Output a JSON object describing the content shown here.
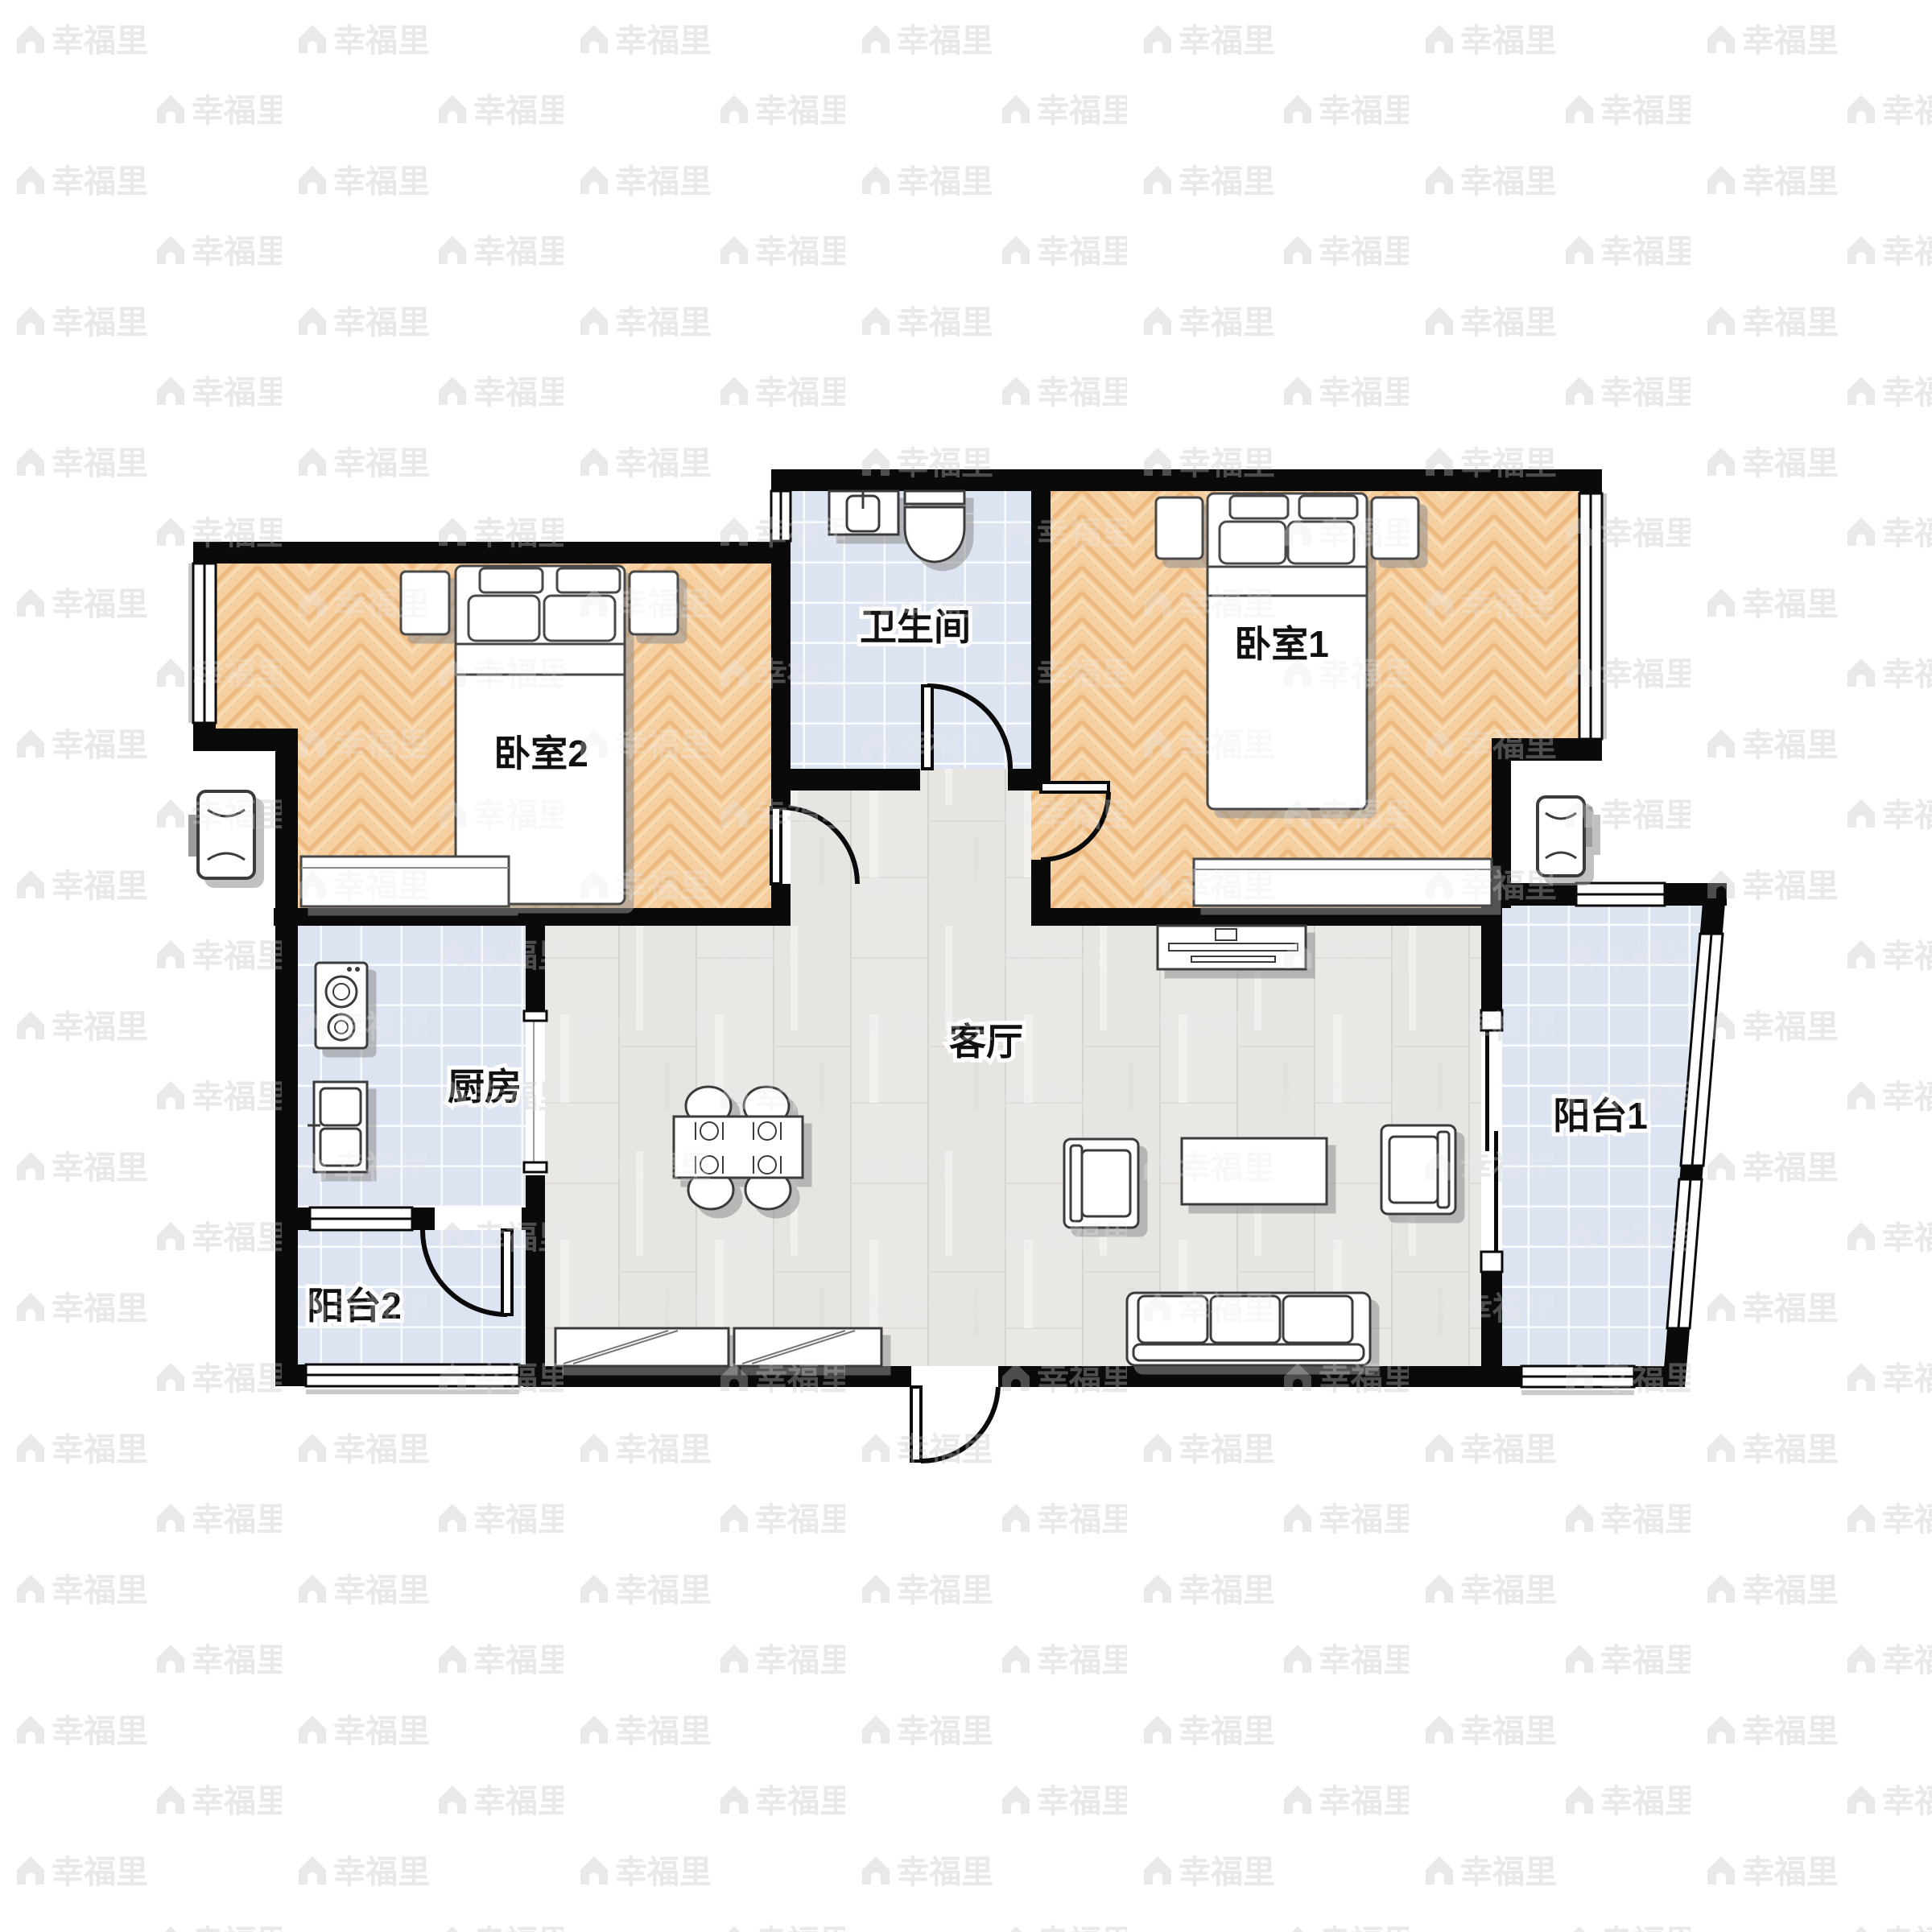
{
  "app": {
    "type": "real-estate floor plan viewer",
    "description": "2-bedroom apartment floor plan (户型图)"
  },
  "watermark": {
    "text": "幸福里"
  },
  "rooms": {
    "bedroom1": {
      "label": "卧室1"
    },
    "bedroom2": {
      "label": "卧室2"
    },
    "bathroom": {
      "label": "卫生间"
    },
    "kitchen": {
      "label": "厨房"
    },
    "living": {
      "label": "客厅"
    },
    "balcony1": {
      "label": "阳台1"
    },
    "balcony2": {
      "label": "阳台2"
    }
  },
  "furniture": {
    "bedroom2": [
      "double-bed",
      "nightstand",
      "nightstand",
      "wardrobe-cabinet"
    ],
    "bedroom1": [
      "double-bed",
      "nightstand",
      "nightstand",
      "wardrobe-cabinet"
    ],
    "bathroom": [
      "vanity-sink",
      "toilet"
    ],
    "kitchen": [
      "stove-two-burner",
      "double-basin-sink"
    ],
    "living": [
      "dining-table-four-chairs",
      "tv-cabinet",
      "tv",
      "armchair",
      "armchair",
      "coffee-table",
      "three-seat-sofa",
      "shoe-cabinet",
      "shoe-cabinet"
    ],
    "exterior": [
      "air-conditioner-unit-left",
      "air-conditioner-unit-right"
    ]
  },
  "colors": {
    "wall": "#0a0a0a",
    "bedroom_floor": "#f6cfa0",
    "living_floor": "#e9e7e4",
    "tile_floor": "#dce3f1",
    "label_text": "#111111",
    "label_halo": "#ffffff",
    "watermark": "#e9e9e9",
    "shadow": "#8f8f8f",
    "background": "#ffffff"
  }
}
